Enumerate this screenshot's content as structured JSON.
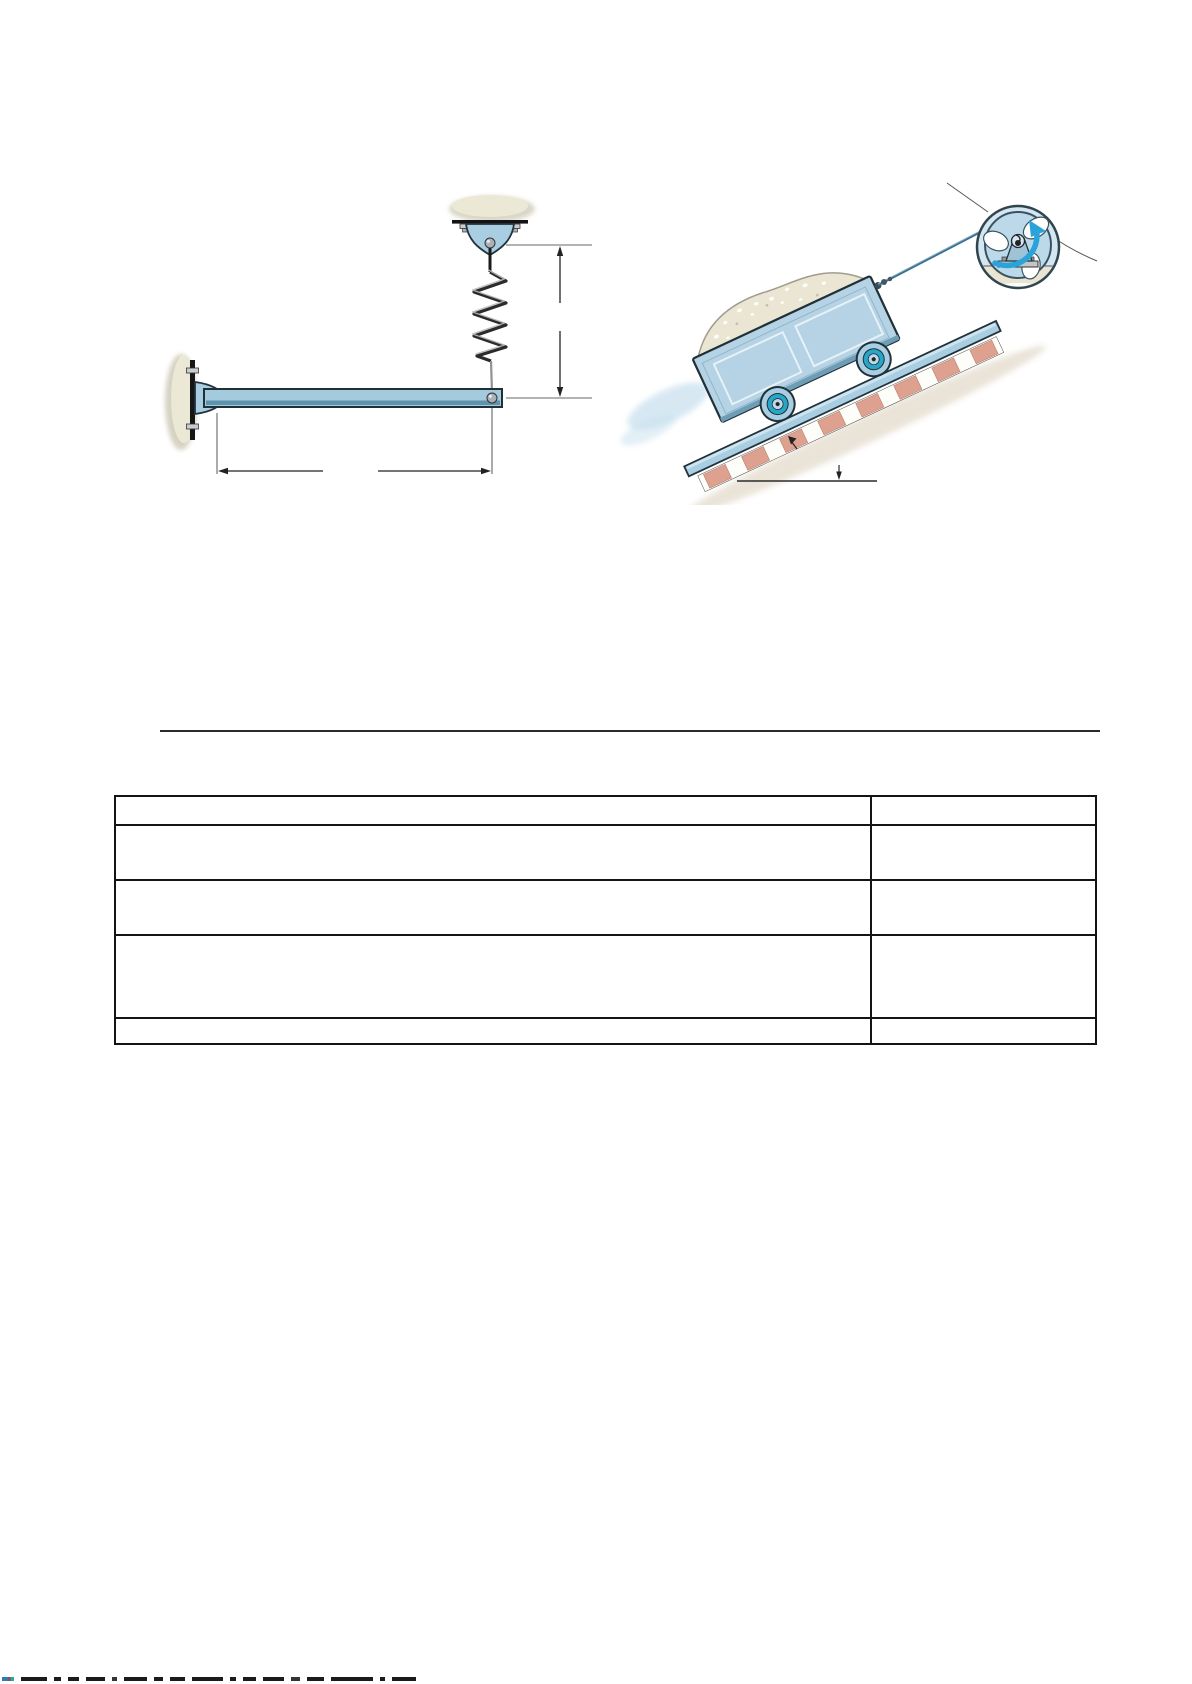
{
  "page": {
    "background": "#ffffff"
  },
  "divider": {
    "color": "#2b2b2b"
  },
  "figures": {
    "beam_spring": {
      "icon": "cantilever-beam-with-hanging-spring-diagram",
      "colors": {
        "steel_blue": "#a9cee2",
        "outline": "#1f3038",
        "mount_beige": "#ece8d6",
        "dimension_line": "#222222"
      },
      "dimension_labels": {
        "vertical": "",
        "horizontal": ""
      }
    },
    "mine_cart": {
      "icon": "mine-cart-on-incline-with-winch-diagram",
      "colors": {
        "cart_blue": "#b5d3e4",
        "rail_blue": "#a9cee2",
        "tie_salmon": "#dfa18f",
        "wheel_teal": "#29a6c7",
        "rotation_arrow_blue": "#2aa3da",
        "ore_beige": "#eae6d3"
      },
      "angle_label": "",
      "callout_labels": {
        "winch_top": "",
        "winch_right": "",
        "track": ""
      }
    }
  },
  "table": {
    "columns": [
      "",
      ""
    ],
    "cells": [
      [
        "",
        ""
      ],
      [
        "",
        ""
      ],
      [
        "",
        ""
      ],
      [
        "",
        ""
      ],
      [
        "",
        ""
      ]
    ]
  }
}
